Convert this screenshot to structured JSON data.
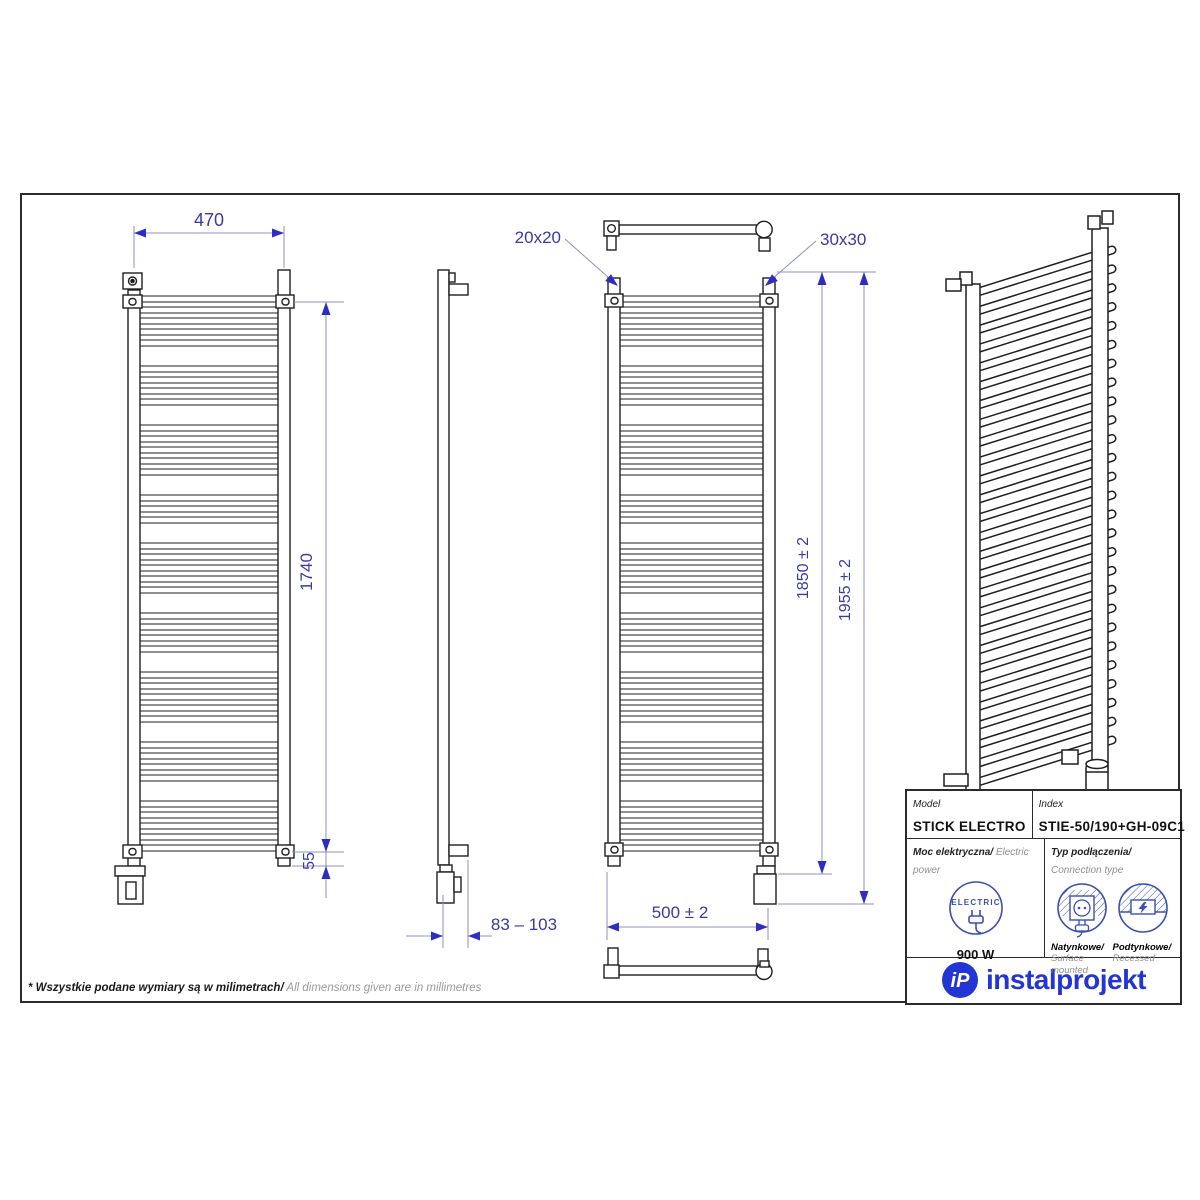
{
  "page": {
    "footnote_pl": "* Wszystkie podane wymiary są w milimetrach/",
    "footnote_en": " All dimensions given are in millimetres"
  },
  "dimensions": {
    "width_top": "470",
    "body_height": "1740",
    "bottom_offset": "55",
    "tube_profile": "20x20",
    "collector_profile": "30x30",
    "height_to_bracket": "1850 ± 2",
    "total_height": "1955 ± 2",
    "axis_width": "500 ± 2",
    "depth_range": "83 – 103"
  },
  "table": {
    "model_label": "Model",
    "model_value": "STICK ELECTRO",
    "index_label": "Index",
    "index_value": "STIE-50/190+GH-09C1",
    "power_label_pl": "Moc elektryczna/",
    "power_label_en": " Electric power",
    "electric_badge": "ELECTRIC",
    "power_value": "900 W",
    "connection_label_pl": "Typ podłączenia/",
    "connection_label_en": "Connection type",
    "surface_label_pl": "Natynkowe/",
    "surface_label_en": "Surface mounted",
    "recessed_label_pl": "Podtynkowe/",
    "recessed_label_en": "Recessed"
  },
  "logo": {
    "monogram": "iP",
    "name": "instalprojekt"
  },
  "colors": {
    "line": "#1f1f1f",
    "dim_line": "#8f8fc2",
    "dim_text": "#3a3aa5",
    "arrow": "#2d2dc2",
    "icon_blue": "#3a4fb0",
    "logo_blue": "#2336d4"
  }
}
